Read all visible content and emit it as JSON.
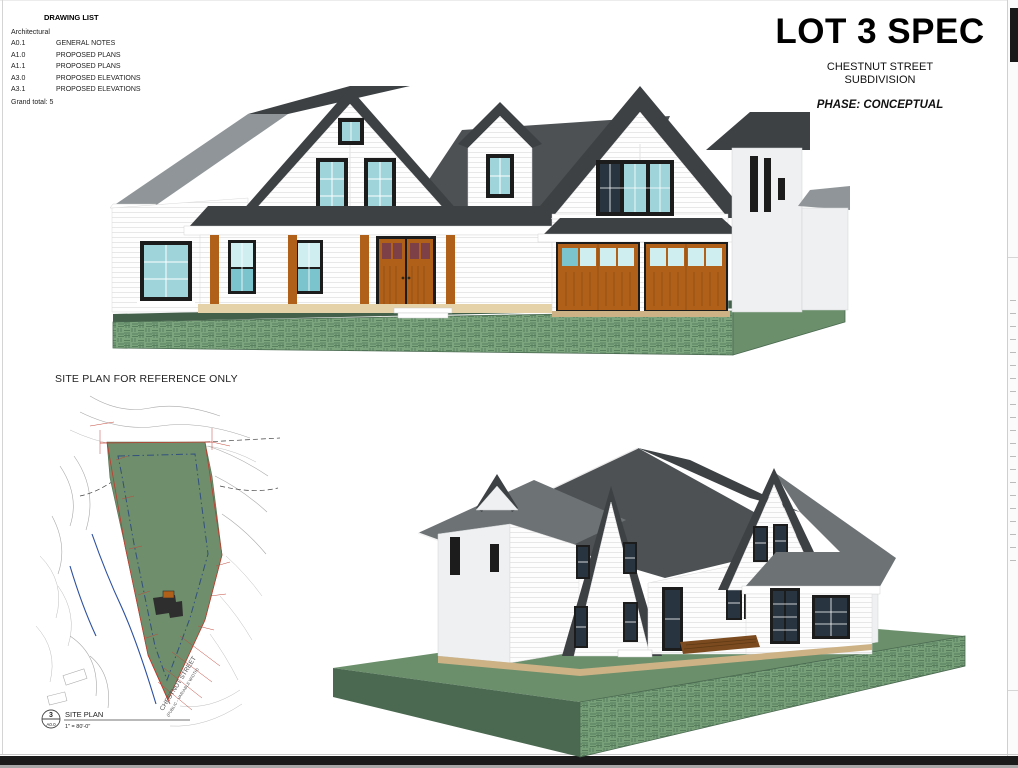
{
  "titleblock": {
    "title": "LOT 3 SPEC",
    "subtitle_line1": "CHESTNUT STREET",
    "subtitle_line2": "SUBDIVISION",
    "phase": "PHASE: CONCEPTUAL"
  },
  "drawing_list": {
    "title": "DRAWING LIST",
    "section": "Architectural",
    "items": [
      {
        "code": "A0.1",
        "name": "GENERAL NOTES"
      },
      {
        "code": "A1.0",
        "name": "PROPOSED PLANS"
      },
      {
        "code": "A1.1",
        "name": "PROPOSED PLANS"
      },
      {
        "code": "A3.0",
        "name": "PROPOSED ELEVATIONS"
      },
      {
        "code": "A3.1",
        "name": "PROPOSED ELEVATIONS"
      }
    ],
    "grand_total": "Grand total: 5"
  },
  "site_plan": {
    "heading": "SITE PLAN FOR REFERENCE ONLY",
    "street_label": "CHESTNUT STREET",
    "street_sublabel": "(PUBLIC - VARIABLE WIDTH)",
    "callout": {
      "number": "3",
      "sheet": "A0.0",
      "title": "SITE PLAN",
      "scale": "1\" = 80'-0\""
    }
  },
  "palette": {
    "roof_dark": "#3d4144",
    "roof_mid": "#6d7275",
    "roof_light": "#8f9598",
    "siding_white": "#ffffff",
    "trim_black": "#1c1c1c",
    "glass_teal": "#9fd4da",
    "glass_navy": "#283440",
    "door_wood": "#b06019",
    "door_pane_red": "#7d4046",
    "porch_tan": "#e6d2a8",
    "grass_front": "#7ca57e",
    "grass_top_dark": "#42604a",
    "grass_side": "#6b8f6b",
    "site_lot_green": "#6e8e6c",
    "survey_red": "#c23b2e",
    "survey_blue": "#2b4fa0"
  }
}
